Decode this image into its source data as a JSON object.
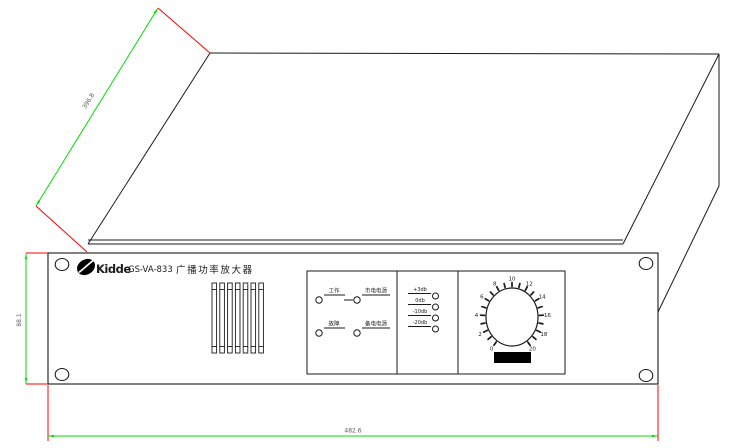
{
  "product": {
    "brand": "Kidde",
    "model": "GS-VA-833",
    "name": "广播功率放大器"
  },
  "panel": {
    "status_indicators": [
      {
        "label": "工作"
      },
      {
        "label": "市电电源"
      },
      {
        "label": "故障"
      },
      {
        "label": "备电电源"
      }
    ],
    "level_indicators": [
      {
        "label": "+3db"
      },
      {
        "label": "0db"
      },
      {
        "label": "-10db"
      },
      {
        "label": "-20db"
      }
    ],
    "knob": {
      "min": 0,
      "max": 20,
      "numbers": [
        0,
        2,
        4,
        6,
        8,
        10,
        12,
        14,
        16,
        18,
        20
      ]
    }
  },
  "dimensions": {
    "depth": "396.8",
    "height": "88.1",
    "width": "482.6"
  },
  "colors": {
    "dimension_line": "#00dc00",
    "extension_line": "#ff0000",
    "dimension_text": "#5a5a5a",
    "outline": "#1a1a1a"
  }
}
